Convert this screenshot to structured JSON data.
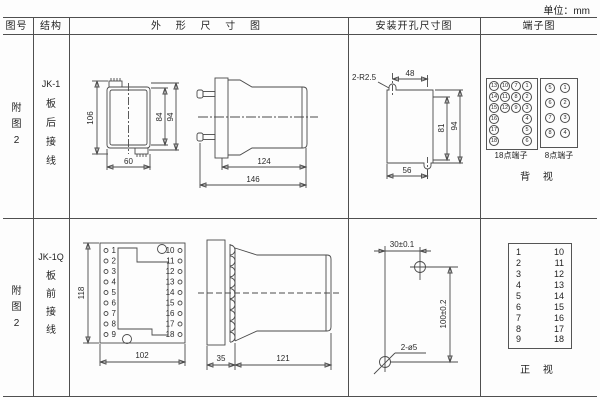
{
  "unit_label": "单位：mm",
  "headers": {
    "fig_no": "图号",
    "structure": "结构",
    "outline": "外 形 尺 寸 图",
    "mounting": "安装开孔尺寸图",
    "terminal": "端子图"
  },
  "row1": {
    "fig_no_chars": [
      "附",
      "图",
      "2"
    ],
    "model": "JK-1",
    "wiring_chars": [
      "板",
      "后",
      "接",
      "线"
    ],
    "front": {
      "h106": "106",
      "h84": "84",
      "h94": "94",
      "w60": "60"
    },
    "side": {
      "l124": "124",
      "l146": "146"
    },
    "mount": {
      "slot": "2-R2.5",
      "w48": "48",
      "h81": "81",
      "h94": "94",
      "w56": "56"
    },
    "t18": {
      "col1": [
        "13",
        "14",
        "15",
        "16",
        "17",
        "18"
      ],
      "col2": [
        "10",
        "11",
        "12"
      ],
      "col3": [
        "7",
        "8",
        "9"
      ],
      "col4": [
        "1",
        "2",
        "3",
        "4",
        "5",
        "6"
      ],
      "label": "18点端子"
    },
    "t8": {
      "col1": [
        "5",
        "6",
        "7",
        "8"
      ],
      "col2": [
        "1",
        "2",
        "3",
        "4"
      ],
      "label": "8点端子"
    },
    "view_label": "背 视"
  },
  "row2": {
    "fig_no_chars": [
      "附",
      "图",
      "2"
    ],
    "model": "JK-1Q",
    "wiring_chars": [
      "板",
      "前",
      "接",
      "线"
    ],
    "front": {
      "h118": "118",
      "w102": "102",
      "left": [
        "1",
        "2",
        "3",
        "4",
        "5",
        "6",
        "7",
        "8",
        "9"
      ],
      "right": [
        "10",
        "11",
        "12",
        "13",
        "14",
        "15",
        "16",
        "17",
        "18"
      ]
    },
    "side": {
      "w35": "35",
      "l121": "121"
    },
    "mount": {
      "h30": "30±0.1",
      "v100": "100±0.2",
      "holes": "2-ø5"
    },
    "tbox": {
      "left": [
        "1",
        "2",
        "3",
        "4",
        "5",
        "6",
        "7",
        "8",
        "9"
      ],
      "right": [
        "10",
        "11",
        "12",
        "13",
        "14",
        "15",
        "16",
        "17",
        "18"
      ]
    },
    "view_label": "正 视"
  }
}
